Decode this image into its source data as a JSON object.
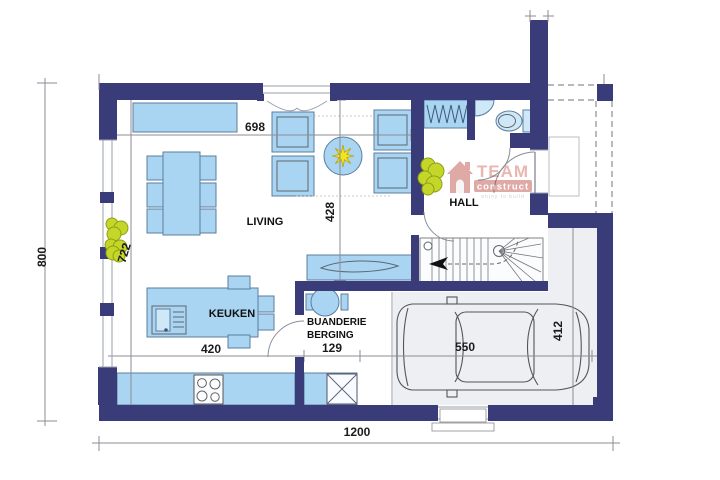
{
  "rooms": {
    "living": "LIVING",
    "hall": "HALL",
    "kitchen": "KEUKEN",
    "laundry_line1": "BUANDERIE",
    "laundry_line2": "BERGING"
  },
  "dimensions": {
    "total_width": "1200",
    "total_depth": "800",
    "living_width": "698",
    "living_depth": "428",
    "left_wall_span": "722",
    "kitchen_width": "420",
    "laundry_width": "129",
    "garage_length": "550",
    "garage_depth": "412"
  },
  "logo": {
    "brand": "TEAM",
    "brand_sub": "construct",
    "tagline": "enjoy to build"
  },
  "colors": {
    "wall": "#3a3c79",
    "furniture": "#a9d5f2",
    "furniture_light": "#cfe8f8",
    "outline": "#5b7f9f",
    "tree": "#c5d62a",
    "tree_outline": "#8fa012",
    "star": "#f2e51d",
    "logo_red": "#b5342c",
    "sketch": "#8a8f99",
    "garage_floor": "#edeff3"
  }
}
